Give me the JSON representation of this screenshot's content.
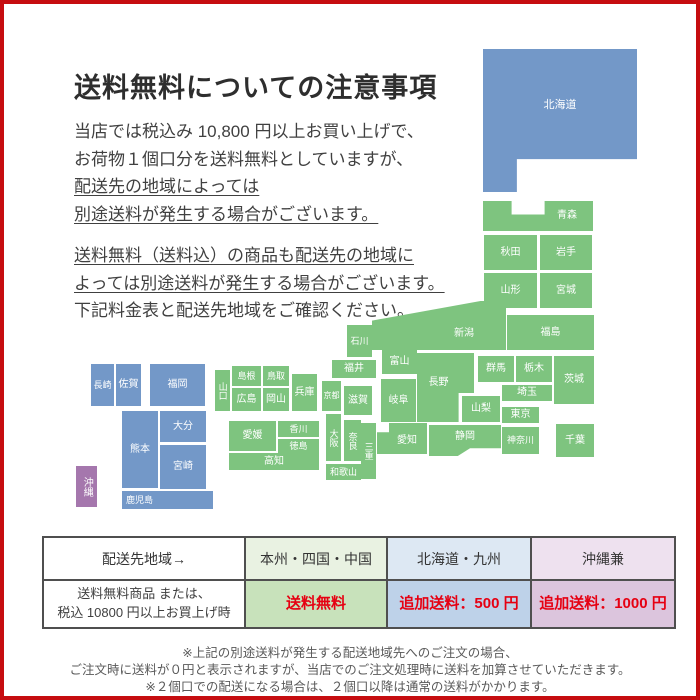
{
  "page": {
    "title": "送料無料についての注意事項",
    "intro_lines": [
      {
        "text": "当店では税込み 10,800 円以上お買い上げで、",
        "u": false
      },
      {
        "text": "お荷物１個口分を送料無料としていますが、",
        "u": false
      },
      {
        "text": "配送先の地域によっては",
        "u": true
      },
      {
        "text": "別途送料が発生する場合がございます。",
        "u": true
      }
    ],
    "second_lines": [
      {
        "text": "送料無料（送料込）の商品も配送先の地域に",
        "u": true
      },
      {
        "text": "よっては別途送料が発生する場合がございます。",
        "u": true
      },
      {
        "text": "下記料金表と配送先地域をご確認ください。",
        "u": false
      }
    ],
    "footer_lines": [
      "※上記の別途送料が発生する配送地域先へのご注文の場合、",
      "ご注文時に送料が０円と表示されますが、当店でのご注文処理時に送料を加算させていただきます。",
      "※２個口での配送になる場合は、２個口以降は通常の送料がかかります。"
    ]
  },
  "colors": {
    "frame": "#c60d10",
    "region_green": "#7ec47f",
    "region_blue": "#7398c8",
    "region_purple": "#a577ad",
    "red_text": "#e60012",
    "table_border": "#4f4f4f"
  },
  "map": {
    "prefectures": [
      {
        "n": "北海道",
        "x": 479,
        "y": 45,
        "w": 154,
        "h": 143,
        "c": "region_blue",
        "fs": 11,
        "shape": "hokkaido",
        "lc": "lbl-hokkaido"
      },
      {
        "n": "青森",
        "x": 479,
        "y": 197,
        "w": 110,
        "h": 30,
        "c": "region_green",
        "shape": "aomori",
        "lc": "lbl-aomori"
      },
      {
        "n": "秋田",
        "x": 480,
        "y": 231,
        "w": 53,
        "h": 35,
        "c": "region_green"
      },
      {
        "n": "岩手",
        "x": 536,
        "y": 231,
        "w": 52,
        "h": 35,
        "c": "region_green"
      },
      {
        "n": "山形",
        "x": 480,
        "y": 269,
        "w": 53,
        "h": 35,
        "c": "region_green"
      },
      {
        "n": "宮城",
        "x": 536,
        "y": 269,
        "w": 52,
        "h": 35,
        "c": "region_green"
      },
      {
        "n": "福島",
        "x": 503,
        "y": 311,
        "w": 87,
        "h": 35,
        "c": "region_green"
      },
      {
        "n": "新潟",
        "x": 368,
        "y": 297,
        "w": 134,
        "h": 49,
        "c": "region_green",
        "shape": "niigata",
        "lc": "lbl-niigata"
      },
      {
        "n": "石川",
        "x": 343,
        "y": 321,
        "w": 25,
        "h": 32,
        "c": "region_green",
        "fs": 9
      },
      {
        "n": "富山",
        "x": 378,
        "y": 345,
        "w": 35,
        "h": 25,
        "c": "region_green"
      },
      {
        "n": "福井",
        "x": 328,
        "y": 356,
        "w": 44,
        "h": 18,
        "c": "region_green"
      },
      {
        "n": "長野",
        "x": 413,
        "y": 349,
        "w": 57,
        "h": 69,
        "c": "region_green",
        "shape": "nagano",
        "lc": "lbl-nagano"
      },
      {
        "n": "群馬",
        "x": 474,
        "y": 352,
        "w": 36,
        "h": 26,
        "c": "region_green"
      },
      {
        "n": "栃木",
        "x": 512,
        "y": 352,
        "w": 36,
        "h": 26,
        "c": "region_green"
      },
      {
        "n": "茨城",
        "x": 550,
        "y": 352,
        "w": 40,
        "h": 48,
        "c": "region_green"
      },
      {
        "n": "埼玉",
        "x": 498,
        "y": 381,
        "w": 50,
        "h": 16,
        "c": "region_green"
      },
      {
        "n": "山梨",
        "x": 458,
        "y": 392,
        "w": 38,
        "h": 26,
        "c": "region_green"
      },
      {
        "n": "東京",
        "x": 498,
        "y": 403,
        "w": 37,
        "h": 16,
        "c": "region_green"
      },
      {
        "n": "神奈川",
        "x": 498,
        "y": 423,
        "w": 37,
        "h": 27,
        "c": "region_green",
        "fs": 9
      },
      {
        "n": "千葉",
        "x": 552,
        "y": 420,
        "w": 38,
        "h": 33,
        "c": "region_green"
      },
      {
        "n": "岐阜",
        "x": 377,
        "y": 375,
        "w": 35,
        "h": 43,
        "c": "region_green"
      },
      {
        "n": "静岡",
        "x": 425,
        "y": 421,
        "w": 72,
        "h": 31,
        "c": "region_green",
        "shape": "shizuoka",
        "lc": "lbl-shizuoka"
      },
      {
        "n": "愛知",
        "x": 373,
        "y": 419,
        "w": 50,
        "h": 31,
        "c": "region_green",
        "shape": "aichi",
        "lc": "lbl-aichi"
      },
      {
        "n": "三重",
        "x": 357,
        "y": 419,
        "w": 15,
        "h": 56,
        "c": "region_green",
        "fs": 9,
        "vert": true
      },
      {
        "n": "滋賀",
        "x": 340,
        "y": 382,
        "w": 28,
        "h": 29,
        "c": "region_green"
      },
      {
        "n": "京都",
        "x": 318,
        "y": 377,
        "w": 19,
        "h": 30,
        "c": "region_green",
        "fs": 8
      },
      {
        "n": "兵庫",
        "x": 288,
        "y": 370,
        "w": 25,
        "h": 37,
        "c": "region_green"
      },
      {
        "n": "大阪",
        "x": 322,
        "y": 410,
        "w": 15,
        "h": 47,
        "c": "region_green",
        "fs": 9,
        "vert": true
      },
      {
        "n": "奈良",
        "x": 340,
        "y": 416,
        "w": 17,
        "h": 41,
        "c": "region_green",
        "fs": 9,
        "vert": true
      },
      {
        "n": "和歌山",
        "x": 322,
        "y": 460,
        "w": 35,
        "h": 16,
        "c": "region_green",
        "fs": 9
      },
      {
        "n": "鳥取",
        "x": 259,
        "y": 362,
        "w": 26,
        "h": 20,
        "c": "region_green",
        "fs": 9
      },
      {
        "n": "島根",
        "x": 228,
        "y": 362,
        "w": 29,
        "h": 20,
        "c": "region_green",
        "fs": 9
      },
      {
        "n": "山口",
        "x": 211,
        "y": 366,
        "w": 15,
        "h": 41,
        "c": "region_green",
        "fs": 9,
        "vert": true
      },
      {
        "n": "広島",
        "x": 228,
        "y": 384,
        "w": 29,
        "h": 23,
        "c": "region_green"
      },
      {
        "n": "岡山",
        "x": 259,
        "y": 384,
        "w": 26,
        "h": 23,
        "c": "region_green"
      },
      {
        "n": "香川",
        "x": 274,
        "y": 417,
        "w": 41,
        "h": 16,
        "c": "region_green",
        "fs": 9
      },
      {
        "n": "徳島",
        "x": 274,
        "y": 435,
        "w": 41,
        "h": 14,
        "c": "region_green",
        "fs": 9
      },
      {
        "n": "愛媛",
        "x": 225,
        "y": 417,
        "w": 47,
        "h": 30,
        "c": "region_green"
      },
      {
        "n": "高知",
        "x": 225,
        "y": 449,
        "w": 90,
        "h": 17,
        "c": "region_green"
      },
      {
        "n": "長崎",
        "x": 87,
        "y": 360,
        "w": 23,
        "h": 42,
        "c": "region_blue",
        "fs": 9
      },
      {
        "n": "佐賀",
        "x": 112,
        "y": 360,
        "w": 25,
        "h": 42,
        "c": "region_blue"
      },
      {
        "n": "福岡",
        "x": 146,
        "y": 360,
        "w": 55,
        "h": 42,
        "c": "region_blue"
      },
      {
        "n": "熊本",
        "x": 118,
        "y": 407,
        "w": 36,
        "h": 77,
        "c": "region_blue"
      },
      {
        "n": "大分",
        "x": 156,
        "y": 407,
        "w": 46,
        "h": 31,
        "c": "region_blue"
      },
      {
        "n": "宮崎",
        "x": 156,
        "y": 441,
        "w": 46,
        "h": 44,
        "c": "region_blue"
      },
      {
        "n": "鹿児島",
        "x": 118,
        "y": 487,
        "w": 91,
        "h": 18,
        "c": "region_blue",
        "fs": 9,
        "lc": "lbl-left"
      },
      {
        "n": "沖縄",
        "x": 72,
        "y": 462,
        "w": 21,
        "h": 41,
        "c": "region_purple",
        "vert": true
      }
    ]
  },
  "table": {
    "col_widths": [
      200,
      140,
      142,
      142
    ],
    "header": [
      {
        "label": "配送先地域→",
        "bg": "#ffffff"
      },
      {
        "label": "本州・四国・中国",
        "bg": "#e9f2e2"
      },
      {
        "label": "北海道・九州",
        "bg": "#dde8f3"
      },
      {
        "label": "沖縄兼",
        "bg": "#eee1ef"
      }
    ],
    "row": [
      {
        "lines": [
          "送料無料商品 または、",
          "税込 10800 円以上お買上げ時"
        ],
        "bg": "#ffffff",
        "red": false
      },
      {
        "lines": [
          "送料無料"
        ],
        "bg": "#c8e2bb",
        "red": true
      },
      {
        "lines": [
          "追加送料：500 円"
        ],
        "bg": "#bed2e9",
        "red": true
      },
      {
        "lines": [
          "追加送料：1000 円"
        ],
        "bg": "#dcc5dd",
        "red": true
      }
    ]
  }
}
